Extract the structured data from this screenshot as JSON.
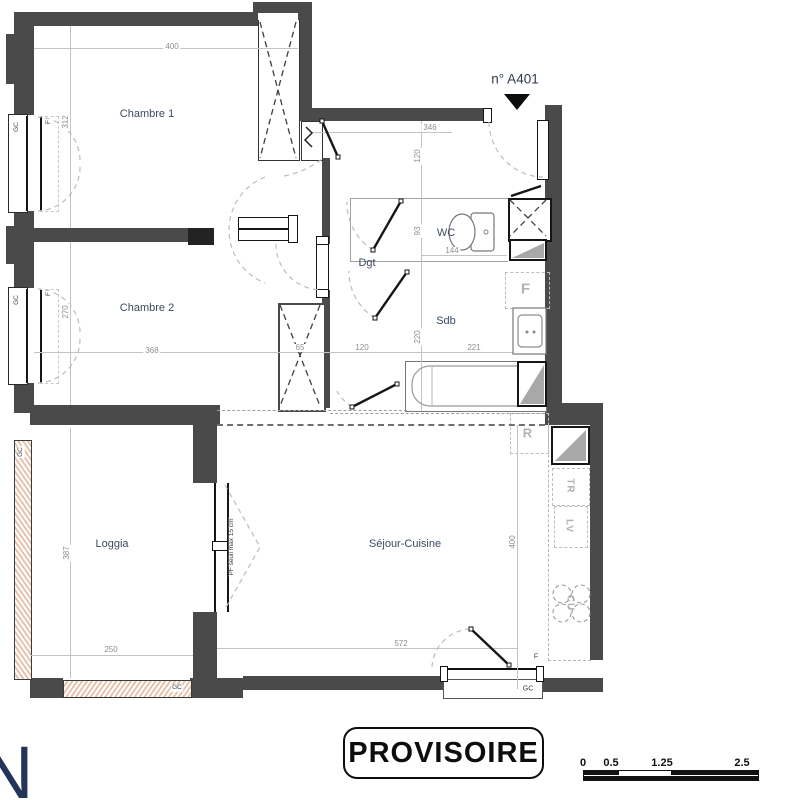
{
  "header": {
    "unit_label": "n° A401"
  },
  "stamp": {
    "text": "PROVISOIRE"
  },
  "logo": {
    "letter": "N"
  },
  "colors": {
    "wall": "#4a4a4a",
    "room_label": "#3b4a60",
    "dimension": "#8e8e8e",
    "appliance": "#b2b2b2",
    "hatch": "#e7c3ad",
    "door": "#161616",
    "logo": "#223457"
  },
  "rooms": [
    {
      "id": "chambre1",
      "label": "Chambre 1",
      "x": 147,
      "y": 114
    },
    {
      "id": "chambre2",
      "label": "Chambre 2",
      "x": 147,
      "y": 308
    },
    {
      "id": "wc",
      "label": "WC",
      "x": 446,
      "y": 233
    },
    {
      "id": "dgt",
      "label": "Dgt",
      "x": 367,
      "y": 263
    },
    {
      "id": "sdb",
      "label": "Sdb",
      "x": 446,
      "y": 321
    },
    {
      "id": "loggia",
      "label": "Loggia",
      "x": 112,
      "y": 544
    },
    {
      "id": "sejour-cuisine",
      "label": "Séjour-Cuisine",
      "x": 405,
      "y": 544
    }
  ],
  "dimensions": [
    {
      "text": "400",
      "x": 172,
      "y": 47,
      "rot": 0
    },
    {
      "text": "312",
      "x": 66,
      "y": 122,
      "rot": -90
    },
    {
      "text": "346",
      "x": 430,
      "y": 128,
      "rot": 0
    },
    {
      "text": "120",
      "x": 418,
      "y": 156,
      "rot": -90
    },
    {
      "text": "93",
      "x": 418,
      "y": 231,
      "rot": -90
    },
    {
      "text": "144",
      "x": 452,
      "y": 251,
      "rot": 0
    },
    {
      "text": "270",
      "x": 66,
      "y": 312,
      "rot": -90
    },
    {
      "text": "368",
      "x": 152,
      "y": 351,
      "rot": 0
    },
    {
      "text": "65",
      "x": 300,
      "y": 348,
      "rot": 0
    },
    {
      "text": "120",
      "x": 362,
      "y": 348,
      "rot": 0
    },
    {
      "text": "221",
      "x": 474,
      "y": 348,
      "rot": 0
    },
    {
      "text": "220",
      "x": 418,
      "y": 337,
      "rot": -90
    },
    {
      "text": "387",
      "x": 67,
      "y": 553,
      "rot": -90
    },
    {
      "text": "250",
      "x": 111,
      "y": 650,
      "rot": 0
    },
    {
      "text": "572",
      "x": 401,
      "y": 644,
      "rot": 0
    },
    {
      "text": "400",
      "x": 513,
      "y": 542,
      "rot": -90
    }
  ],
  "annotations": [
    {
      "text": "GC",
      "x": 17,
      "y": 127,
      "rot": -90,
      "size": 6.5
    },
    {
      "text": "F",
      "x": 49,
      "y": 122,
      "rot": -90,
      "size": 6.5
    },
    {
      "text": "GC",
      "x": 17,
      "y": 300,
      "rot": -90,
      "size": 6.5
    },
    {
      "text": "F",
      "x": 49,
      "y": 294,
      "rot": -90,
      "size": 6.5
    },
    {
      "text": "GC",
      "x": 21,
      "y": 452,
      "rot": -90,
      "size": 6.5
    },
    {
      "text": "GC",
      "x": 177,
      "y": 688,
      "rot": 0,
      "size": 6.5
    },
    {
      "text": "GC",
      "x": 528,
      "y": 689,
      "rot": 0,
      "size": 7
    },
    {
      "text": "F",
      "x": 536,
      "y": 657,
      "rot": 0,
      "size": 7
    },
    {
      "text": "PF seuil max 15 cm",
      "x": 232,
      "y": 547,
      "rot": -90,
      "size": 6.5
    }
  ],
  "appliance_labels": [
    {
      "text": "R",
      "x": 528,
      "y": 433,
      "rot": 0,
      "size": 13
    },
    {
      "text": "F",
      "x": 526,
      "y": 289,
      "rot": 0,
      "size": 15
    },
    {
      "text": "TR",
      "x": 570,
      "y": 486,
      "rot": 90,
      "size": 10
    },
    {
      "text": "LV",
      "x": 569,
      "y": 526,
      "rot": 90,
      "size": 10
    },
    {
      "text": "CU",
      "x": 570,
      "y": 603,
      "rot": 90,
      "size": 10
    }
  ],
  "scale_bar": {
    "labels": [
      {
        "text": "0",
        "x": 583
      },
      {
        "text": "0.5",
        "x": 611
      },
      {
        "text": "1.25",
        "x": 662
      },
      {
        "text": "2.5",
        "x": 742
      }
    ]
  }
}
